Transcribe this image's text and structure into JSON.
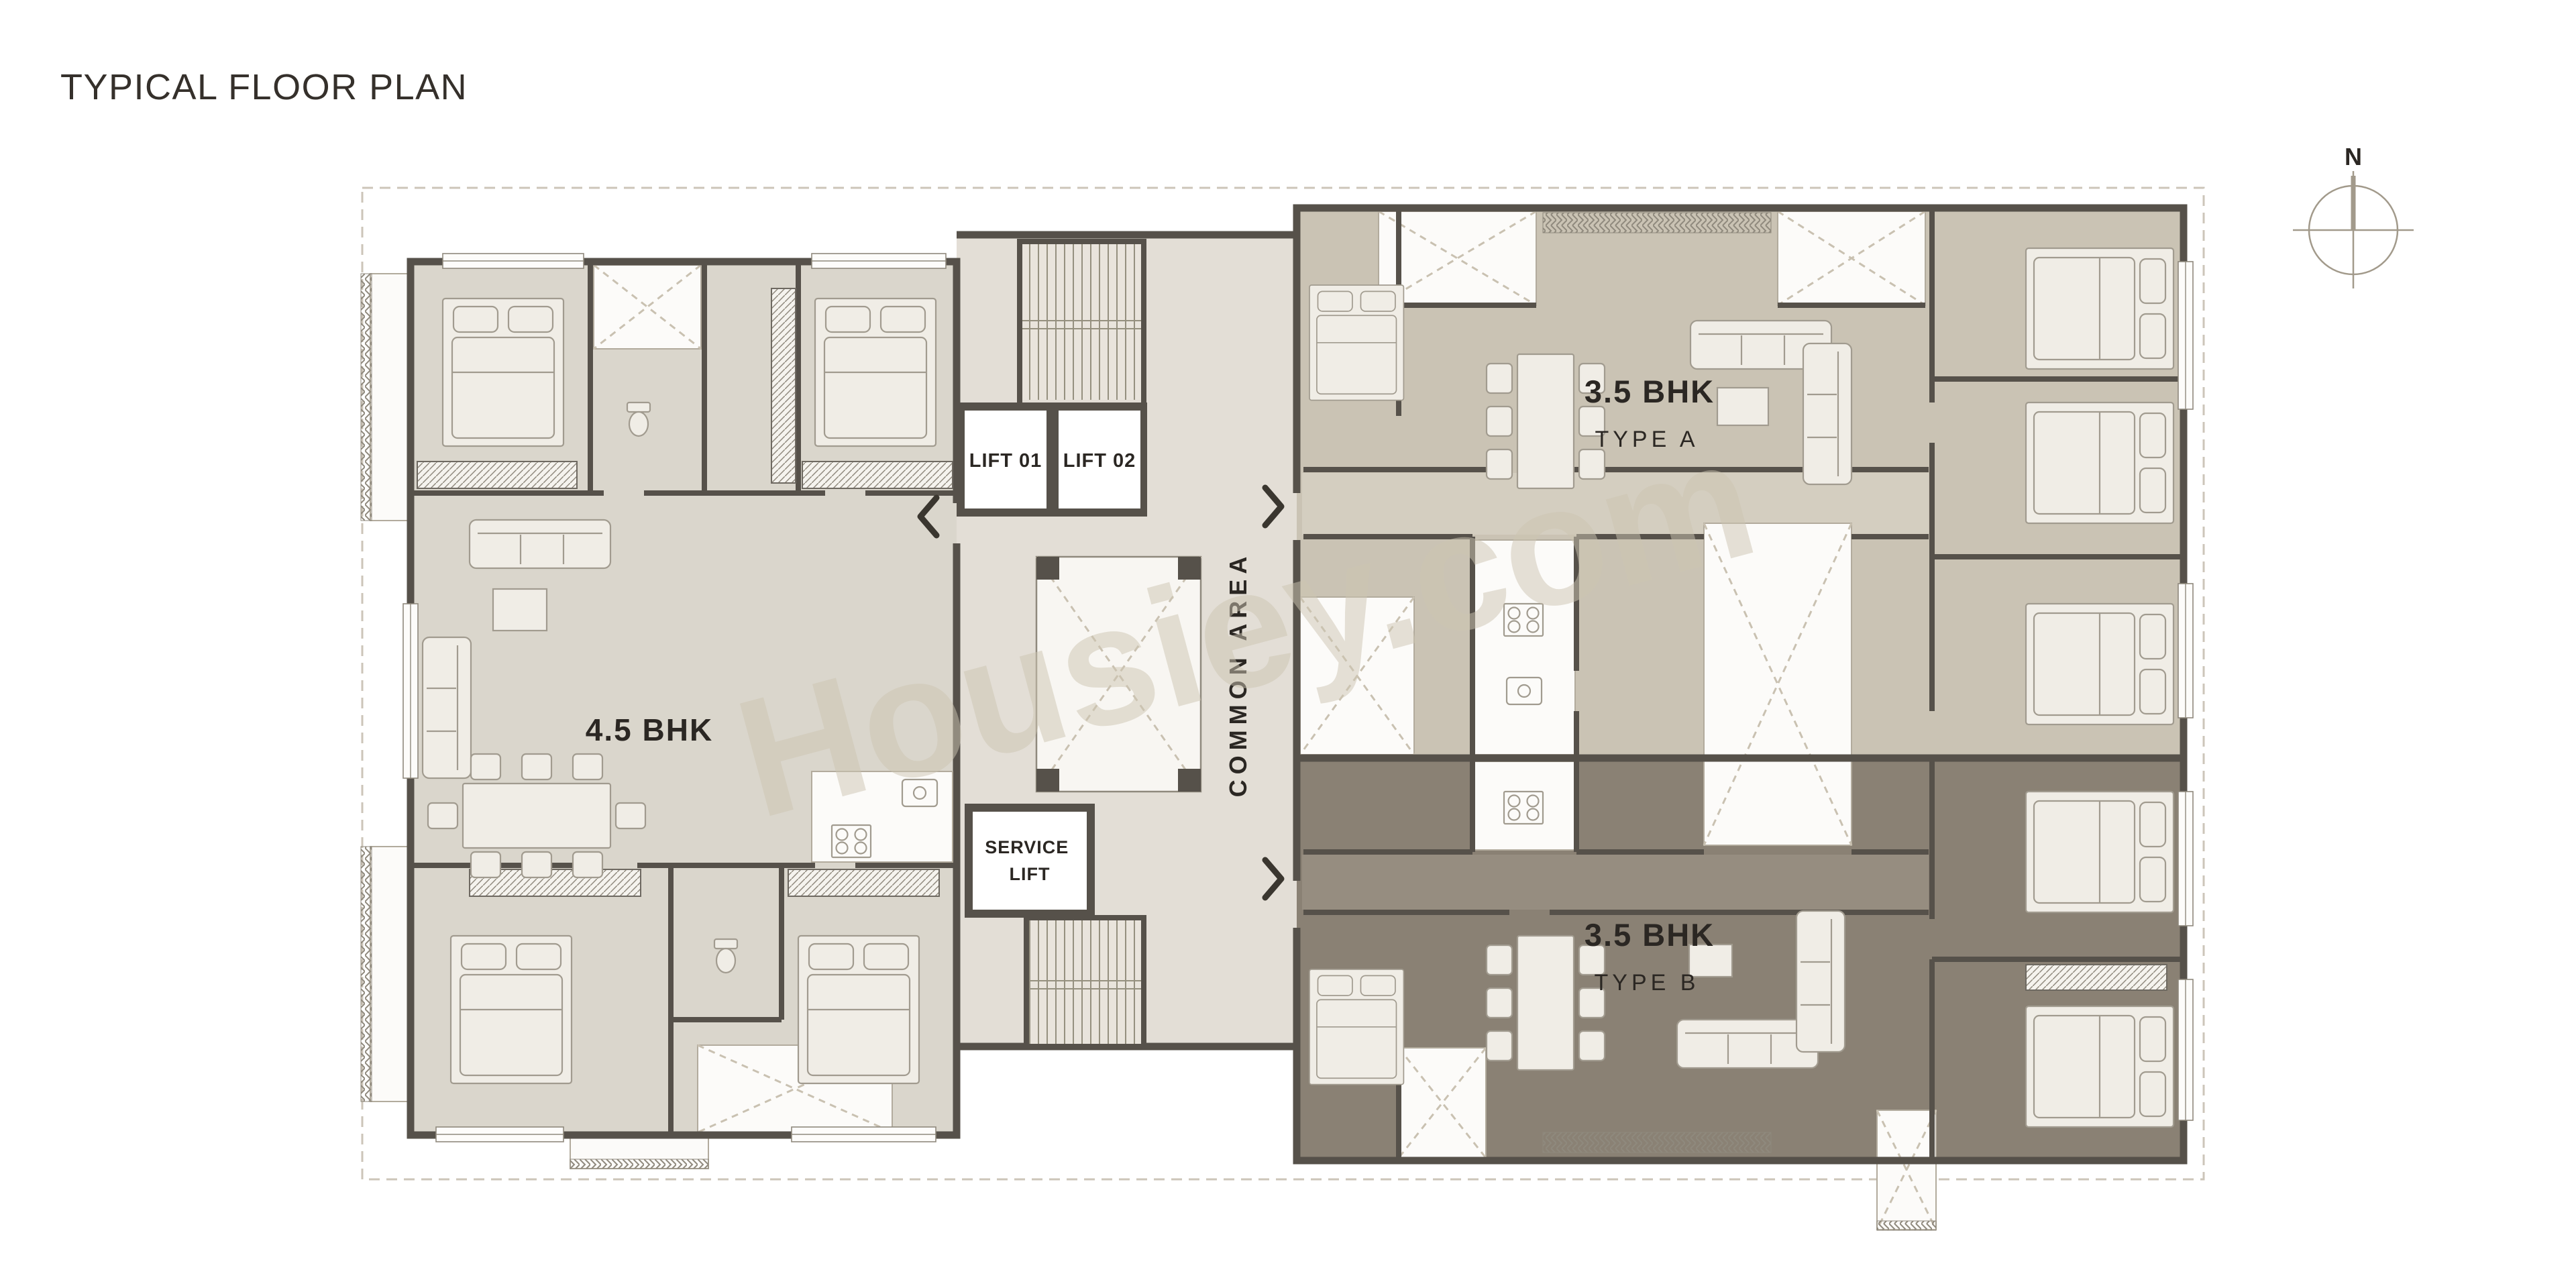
{
  "page": {
    "title": "TYPICAL FLOOR PLAN",
    "watermark": "Housiey.com"
  },
  "compass": {
    "north": "N"
  },
  "units": {
    "bhk45": {
      "label": "4.5 BHK"
    },
    "typeA": {
      "label": "3.5 BHK",
      "sublabel": "TYPE A"
    },
    "typeB": {
      "label": "3.5 BHK",
      "sublabel": "TYPE B"
    }
  },
  "core": {
    "lift1": "LIFT 01",
    "lift2": "LIFT 02",
    "service_lift": {
      "line1": "SERVICE",
      "line2": "LIFT"
    },
    "common_area": "COMMON AREA"
  },
  "icons": {
    "entry_45bhk": "chevron-left",
    "entry_type_a": "chevron-right",
    "entry_type_b": "chevron-right",
    "compass": "north-compass"
  },
  "colors": {
    "wall": "#56514a",
    "unit_45_fill": "#dad6cc",
    "type_a_fill": "#cac3b4",
    "type_b_fill": "#8a8174",
    "corridor_fill": "#e3ded6",
    "corridor_a_band": "#d4cec0",
    "corridor_b_band": "#968d80",
    "lobby_fill": "#f8f6f2",
    "text": "#2b2723",
    "watermark": "#cdc5b2",
    "compass": "#9a9183"
  }
}
